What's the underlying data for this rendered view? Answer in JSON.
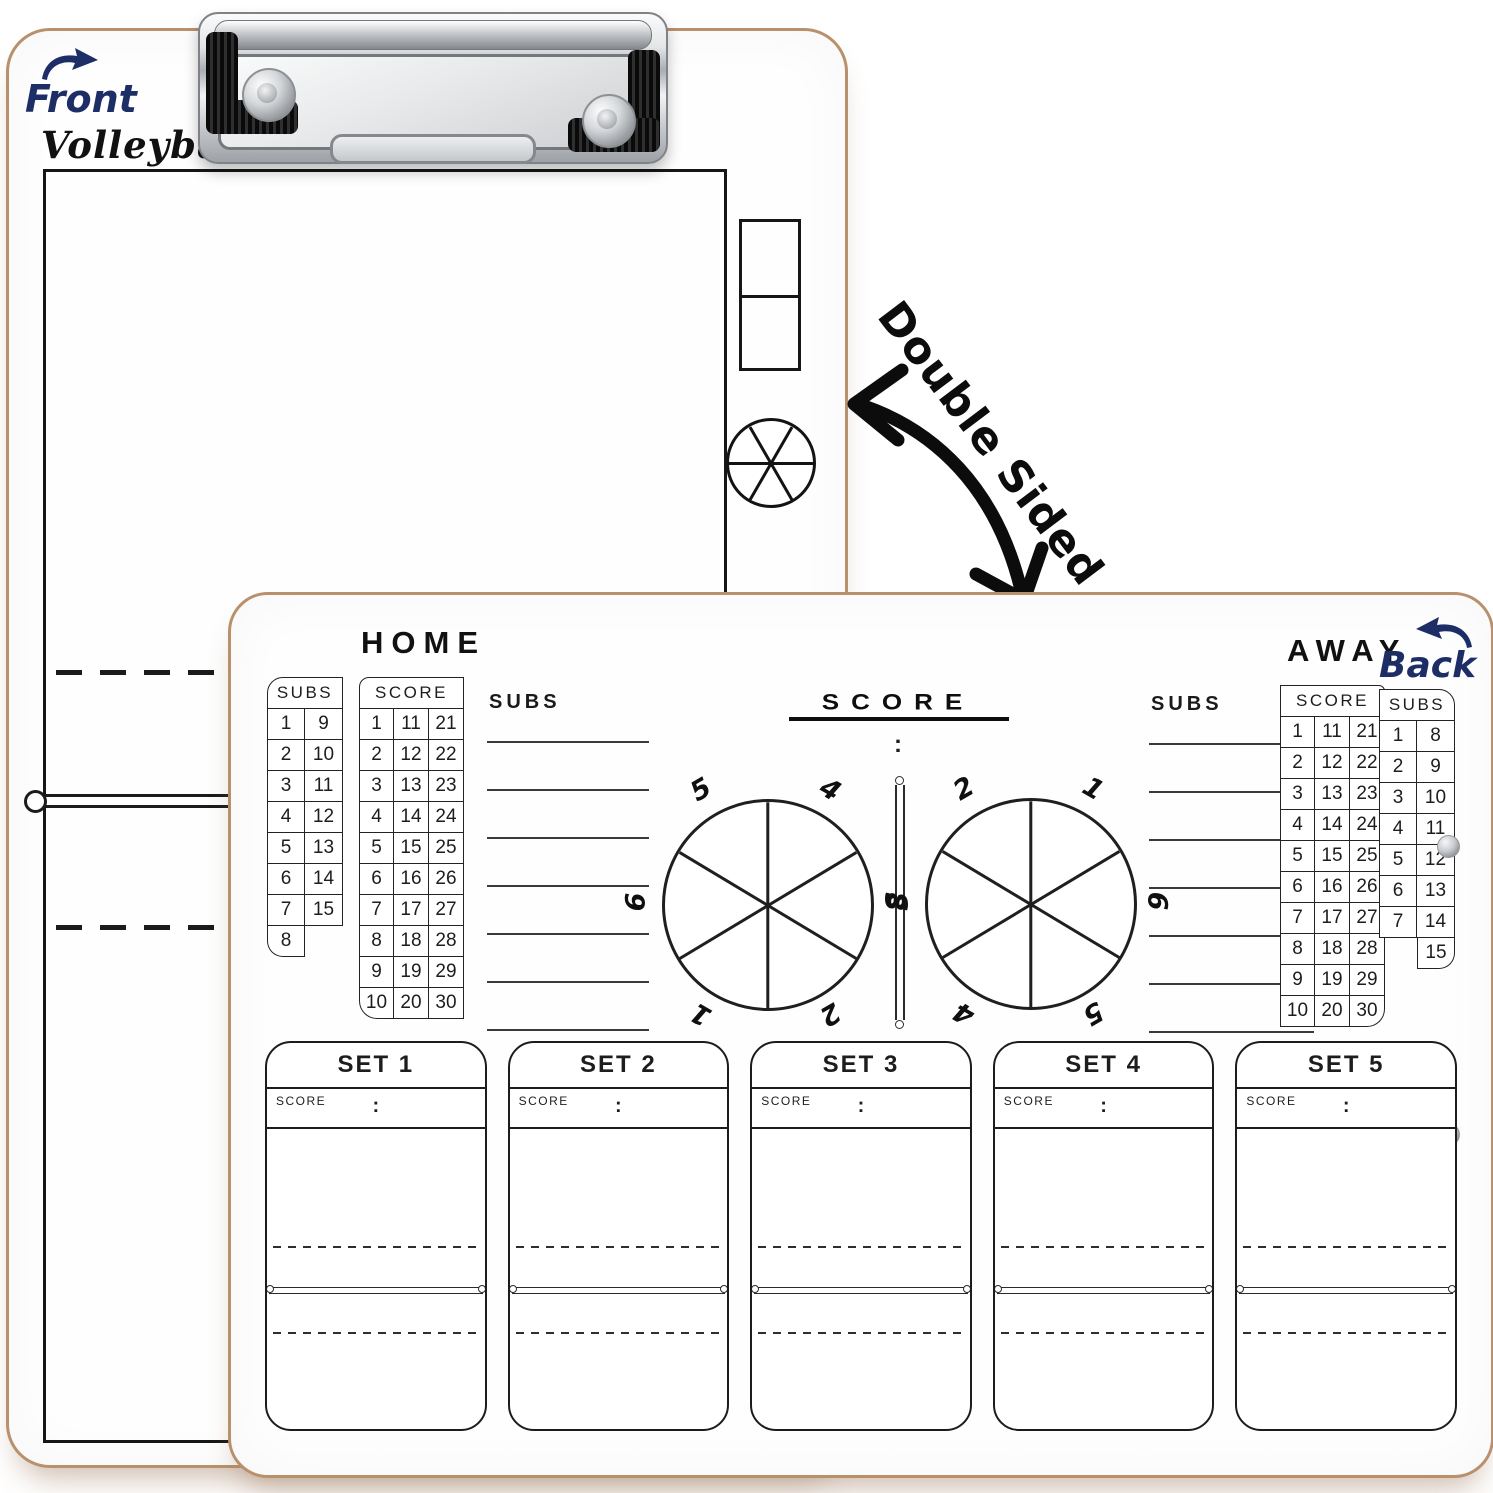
{
  "front_board": {
    "side_label": "Front",
    "sport_title": "Volleyball"
  },
  "double_sided_note": "Double Sided",
  "back_board": {
    "side_label": "Back",
    "home": {
      "title": "HOME",
      "subs_table": {
        "header": "SUBS",
        "rows": [
          [
            "1",
            "9"
          ],
          [
            "2",
            "10"
          ],
          [
            "3",
            "11"
          ],
          [
            "4",
            "12"
          ],
          [
            "5",
            "13"
          ],
          [
            "6",
            "14"
          ],
          [
            "7",
            "15"
          ],
          [
            "8",
            null
          ]
        ]
      },
      "score_table": {
        "header": "SCORE",
        "rows": [
          [
            "1",
            "11",
            "21"
          ],
          [
            "2",
            "12",
            "22"
          ],
          [
            "3",
            "13",
            "23"
          ],
          [
            "4",
            "14",
            "24"
          ],
          [
            "5",
            "15",
            "25"
          ],
          [
            "6",
            "16",
            "26"
          ],
          [
            "7",
            "17",
            "27"
          ],
          [
            "8",
            "18",
            "28"
          ],
          [
            "9",
            "19",
            "29"
          ],
          [
            "10",
            "20",
            "30"
          ]
        ]
      },
      "subs_lines": {
        "label": "SUBS",
        "count": 7
      }
    },
    "away": {
      "title": "AWAY",
      "score_table": {
        "header": "SCORE",
        "rows": [
          [
            "1",
            "11",
            "21"
          ],
          [
            "2",
            "12",
            "22"
          ],
          [
            "3",
            "13",
            "23"
          ],
          [
            "4",
            "14",
            "24"
          ],
          [
            "5",
            "15",
            "25"
          ],
          [
            "6",
            "16",
            "26"
          ],
          [
            "7",
            "17",
            "27"
          ],
          [
            "8",
            "18",
            "28"
          ],
          [
            "9",
            "19",
            "29"
          ],
          [
            "10",
            "20",
            "30"
          ]
        ]
      },
      "subs_table": {
        "header": "SUBS",
        "rows": [
          [
            "1",
            "8"
          ],
          [
            "2",
            "9"
          ],
          [
            "3",
            "10"
          ],
          [
            "4",
            "11"
          ],
          [
            "5",
            "12"
          ],
          [
            "6",
            "13"
          ],
          [
            "7",
            "14"
          ],
          [
            null,
            "15"
          ]
        ]
      },
      "subs_lines": {
        "label": "SUBS",
        "count": 7
      }
    },
    "center": {
      "title": "SCORE",
      "colon": ":",
      "home_rotation_numbers": [
        "3",
        "4",
        "5",
        "6",
        "1",
        "2"
      ],
      "away_rotation_numbers": [
        "6",
        "1",
        "2",
        "3",
        "4",
        "5"
      ]
    },
    "sets": [
      {
        "title": "SET 1",
        "score_label": "SCORE",
        "colon": ":"
      },
      {
        "title": "SET 2",
        "score_label": "SCORE",
        "colon": ":"
      },
      {
        "title": "SET 3",
        "score_label": "SCORE",
        "colon": ":"
      },
      {
        "title": "SET 4",
        "score_label": "SCORE",
        "colon": ":"
      },
      {
        "title": "SET 5",
        "score_label": "SCORE",
        "colon": ":"
      }
    ]
  },
  "colors": {
    "board_edge_wood": "#b9906c",
    "line_ink": "#1d1d1d",
    "handwritten_navy": "#1d2d66",
    "metal_chrome": "#c7cacd"
  }
}
